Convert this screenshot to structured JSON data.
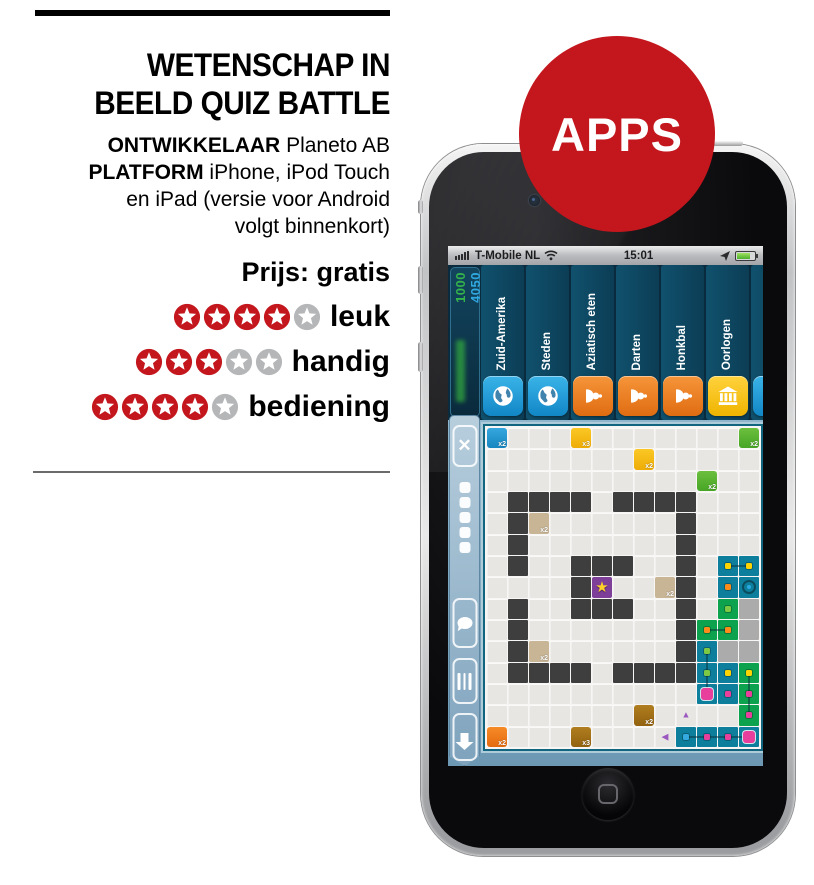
{
  "review": {
    "title_line1": "WETENSCHAP IN",
    "title_line2": "BEELD QUIZ BATTLE",
    "developer_label": "ONTWIKKELAAR",
    "developer_value": "Planeto AB",
    "platform_label": "PLATFORM",
    "platform_value_line1": "iPhone, iPod Touch",
    "platform_value_line2": "en iPad (versie voor Android",
    "platform_value_line3": "volgt binnenkort)",
    "price": "Prijs: gratis",
    "ratings": [
      {
        "label": "leuk",
        "value": 4,
        "max": 5
      },
      {
        "label": "handig",
        "value": 3,
        "max": 5
      },
      {
        "label": "bediening",
        "value": 4,
        "max": 5
      }
    ],
    "colors": {
      "star_filled": "#c3161d",
      "star_empty": "#b4b6b8"
    }
  },
  "badge": {
    "label": "APPS",
    "color": "#c3161d"
  },
  "phone": {
    "status_bar": {
      "carrier": "T-Mobile NL",
      "time": "15:01",
      "icons": [
        "signal-bars-icon",
        "wifi-icon",
        "location-arrow-icon",
        "battery-icon"
      ]
    },
    "app": {
      "scores": {
        "score_green": "1000",
        "score_blue": "4050"
      },
      "categories": [
        {
          "label": "Zuid-Amerika",
          "icon": "globe",
          "color": "blue"
        },
        {
          "label": "Steden",
          "icon": "globe",
          "color": "blue"
        },
        {
          "label": "Aziatisch eten",
          "icon": "pawn",
          "color": "orange"
        },
        {
          "label": "Darten",
          "icon": "pawn",
          "color": "orange"
        },
        {
          "label": "Honkbal",
          "icon": "pawn",
          "color": "orange"
        },
        {
          "label": "Oorlogen",
          "icon": "bank",
          "color": "yellow"
        },
        {
          "label": "Plaatsen",
          "icon": "globe",
          "color": "blue"
        }
      ],
      "sidebar_buttons": [
        "close",
        "pager-dots",
        "chat",
        "queue-lines",
        "download-arrow"
      ],
      "board": {
        "cols": 13,
        "rows": 15,
        "rows_map": [
          "B...Y.......G",
          ".......Y.....",
          "..........G..",
          ".DDDD.DDDD...",
          ".DT......D...",
          ".D.......D...",
          ".D..DDD..D.CC",
          "....DP..TD.CC",
          ".D..DDD..D.EA",
          ".D.......DEEA",
          ".DT......DCAA",
          ".DDDD.DDDDCCE",
          "..........CCE",
          ".......N....E",
          "O...N....CCCC"
        ],
        "cell_labels": [
          {
            "r": 0,
            "c": 0,
            "t": "x2"
          },
          {
            "r": 0,
            "c": 4,
            "t": "x3"
          },
          {
            "r": 0,
            "c": 12,
            "t": "x2"
          },
          {
            "r": 1,
            "c": 7,
            "t": "x2"
          },
          {
            "r": 2,
            "c": 10,
            "t": "x2"
          },
          {
            "r": 4,
            "c": 2,
            "t": "x2"
          },
          {
            "r": 7,
            "c": 8,
            "t": "x2"
          },
          {
            "r": 10,
            "c": 2,
            "t": "x2"
          },
          {
            "r": 13,
            "c": 7,
            "t": "x2"
          },
          {
            "r": 14,
            "c": 0,
            "t": "x2"
          },
          {
            "r": 14,
            "c": 4,
            "t": "x3"
          }
        ],
        "star_cell": {
          "r": 7,
          "c": 5,
          "glyph": "★"
        },
        "dots": [
          {
            "r": 6,
            "c": 11,
            "color": "yellow",
            "link": "r"
          },
          {
            "r": 6,
            "c": 12,
            "color": "yellow"
          },
          {
            "r": 7,
            "c": 11,
            "color": "orange"
          },
          {
            "r": 8,
            "c": 11,
            "color": "green"
          },
          {
            "r": 9,
            "c": 10,
            "color": "orange",
            "link": "r"
          },
          {
            "r": 9,
            "c": 11,
            "color": "orange"
          },
          {
            "r": 10,
            "c": 10,
            "color": "green",
            "link": "d"
          },
          {
            "r": 11,
            "c": 10,
            "color": "green",
            "link": "d"
          },
          {
            "r": 11,
            "c": 11,
            "color": "yellow"
          },
          {
            "r": 11,
            "c": 12,
            "color": "yellow",
            "link": "d"
          },
          {
            "r": 12,
            "c": 10,
            "color": "magenta",
            "big": true
          },
          {
            "r": 12,
            "c": 11,
            "color": "magenta"
          },
          {
            "r": 12,
            "c": 12,
            "color": "magenta",
            "link": "d"
          },
          {
            "r": 13,
            "c": 12,
            "color": "magenta"
          },
          {
            "r": 14,
            "c": 9,
            "color": "blue",
            "link": "r"
          },
          {
            "r": 14,
            "c": 10,
            "color": "magenta",
            "link": "r"
          },
          {
            "r": 14,
            "c": 11,
            "color": "magenta",
            "link": "r"
          },
          {
            "r": 14,
            "c": 12,
            "color": "magenta",
            "big": true
          }
        ],
        "markers": [
          {
            "r": 7,
            "c": 12,
            "t": "ring"
          },
          {
            "r": 13,
            "c": 9,
            "t": "tri-up"
          },
          {
            "r": 14,
            "c": 8,
            "t": "tri-left"
          }
        ],
        "dot_palette": {
          "yellow": "#ffd400",
          "orange": "#ff8c1a",
          "green": "#7dc944",
          "magenta": "#e83e9c",
          "blue": "#35aae0"
        }
      }
    }
  }
}
